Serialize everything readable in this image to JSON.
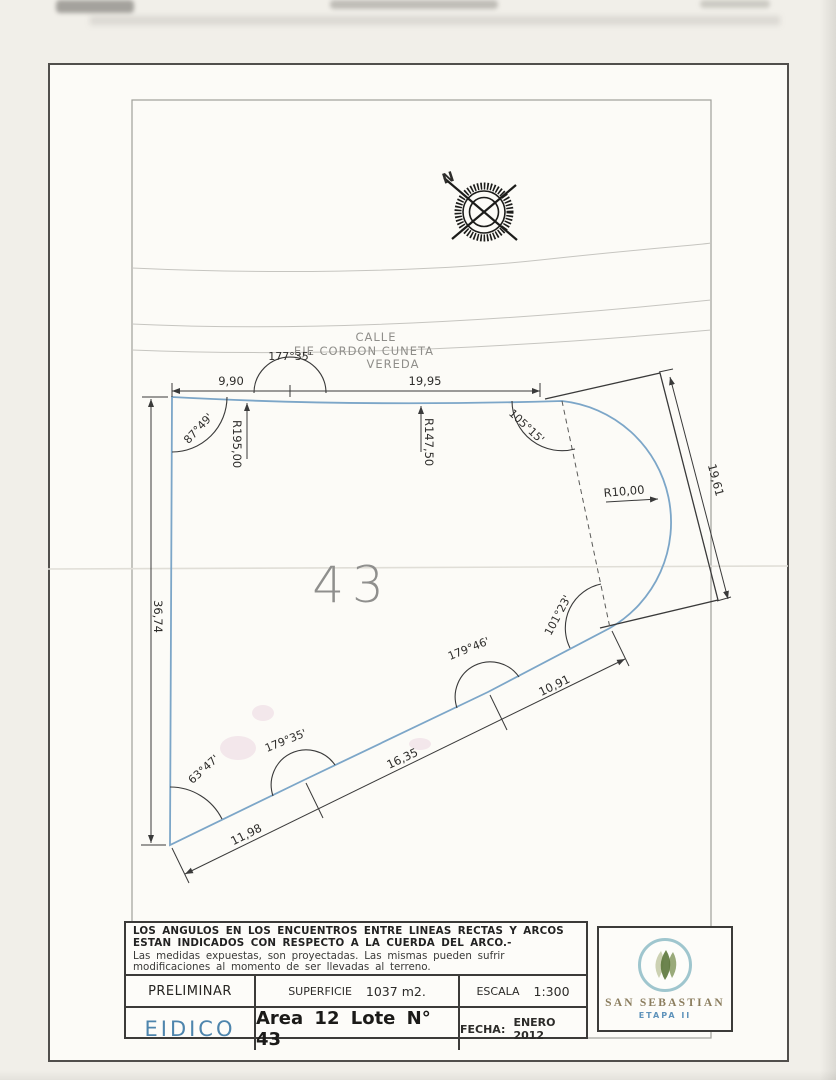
{
  "drawing": {
    "north_label": "N",
    "street_labels": {
      "calle": "CALLE",
      "eje_cordon": "EJE CORDON CUNETA",
      "vereda": "VEREDA"
    },
    "lot_number": "43",
    "dimensions": {
      "top_segment_1": "9,90",
      "top_segment_2": "19,95",
      "right_side": "19,61",
      "left_side": "36,74",
      "bottom_segment_1": "11,98",
      "bottom_segment_2": "16,35",
      "bottom_segment_3": "10,91"
    },
    "radii": {
      "top_arc_1": "R195,00",
      "top_arc_2": "R147,50",
      "corner_arc": "R10,00"
    },
    "angles": {
      "top_left": "87°49'",
      "top_middle": "177°35'",
      "top_right": "105°15'",
      "bottom_right": "101°23'",
      "bottom_3": "179°46'",
      "bottom_2": "179°35'",
      "bottom_left": "63°47'"
    }
  },
  "title_block": {
    "note_line1": "LOS ANGULOS EN LOS ENCUENTROS ENTRE LINEAS RECTAS Y ARCOS ESTAN INDICADOS CON RESPECTO A LA CUERDA DEL ARCO.-",
    "note_line2": "Las medidas expuestas, son proyectadas. Las mismas pueden sufrir modificaciones al momento de ser llevadas al terreno.",
    "status": "PRELIMINAR",
    "superficie_label": "SUPERFICIE",
    "superficie_value": "1037 m2.",
    "escala_label": "ESCALA",
    "escala_value": "1:300",
    "company": "EIDICO",
    "sheet_title": "Area 12 Lote N° 43",
    "fecha_label": "FECHA:",
    "fecha_value": "ENERO 2012"
  },
  "logo": {
    "name": "SAN SEBASTIAN",
    "stage": "ETAPA II"
  },
  "colors": {
    "lot_boundary": "#7ca6c8",
    "drawing_line": "#3a3a3a",
    "faint_line": "#c6c5c0",
    "eidico_blue": "#4e85ad",
    "logo_ring": "#9fc6ce",
    "logo_text": "#8b7d5e",
    "etapa_blue": "#5f93bb",
    "leaf_dark": "#5f7a3f",
    "leaf_mid": "#93a573",
    "leaf_light": "#c9cfae"
  }
}
